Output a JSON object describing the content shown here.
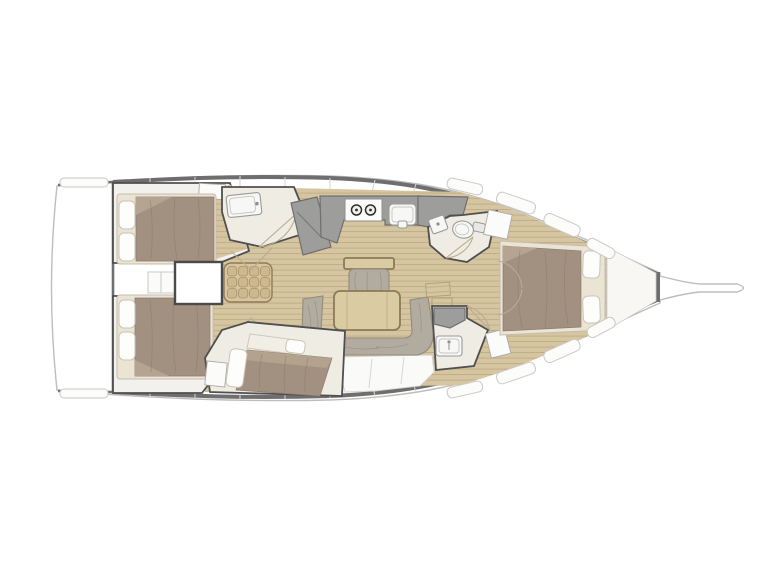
{
  "canvas": {
    "width": 768,
    "height": 576,
    "background": "#ffffff"
  },
  "plan": {
    "kind": "sailing-yacht-interior-floor-plan",
    "orientation": "bow-right-stern-left",
    "colors": {
      "deck_bg": "#ffffff",
      "hull_line": "#bdbdbb",
      "band": "#6e6e6e",
      "panel_line": "#d6d6d4",
      "hatch_line": "#8a8a88",
      "wall": "#4f4f4f",
      "wood": "#d6c5a1",
      "wood_slat": "#c0ab82",
      "step_cell": "#cdb88f",
      "room_floor": "#efece3",
      "bed_base": "#ebe4d5",
      "blanket": "#a29180",
      "blanket_light": "#b5a491",
      "blanket_shadow": "#8c7b6b",
      "pillow": "#fdfdfb",
      "pillow_edge": "#c9c4b4",
      "cushion": "#b2ab9f",
      "cushion_line": "#938b7c",
      "table": "#dbcba2",
      "table_edge": "#8a7a56",
      "counter": "#9d9d9c",
      "counter_edge": "#6f6f6f",
      "fixture": "#f7f7f5",
      "fixture_edge": "#9a9a98",
      "arc": "#b9ab8e"
    },
    "zones": [
      {
        "id": "aft-deck",
        "items": [
          "transom-curve"
        ]
      },
      {
        "id": "aft-cabin-port",
        "items": [
          "double-bed",
          "pillow",
          "pillow",
          "hatched-locker",
          "wood-floor-strip"
        ]
      },
      {
        "id": "aft-cabin-starboard",
        "items": [
          "double-bed",
          "pillow",
          "pillow"
        ]
      },
      {
        "id": "companionway",
        "items": [
          "steps",
          "engine-compartment",
          "shelf-lockers"
        ]
      },
      {
        "id": "head-port",
        "items": [
          "sink",
          "door-swing"
        ]
      },
      {
        "id": "galley",
        "items": [
          "counter",
          "stove-two-burners",
          "sink",
          "fridge-unit"
        ]
      },
      {
        "id": "salon",
        "items": [
          "bench-seat",
          "folding-table",
          "u-shaped-settee",
          "wood-floor"
        ]
      },
      {
        "id": "mid-cabin-starboard",
        "items": [
          "angled-double-bed",
          "pillow",
          "pillow",
          "hatched-locker",
          "headboard"
        ]
      },
      {
        "id": "head-starboard-forward",
        "items": [
          "sink",
          "toilet",
          "door-swing",
          "hanging-locker"
        ]
      },
      {
        "id": "head-starboard-aft",
        "items": [
          "counter",
          "sink",
          "door-swing",
          "hanging-locker"
        ]
      },
      {
        "id": "owner-cabin-bow",
        "items": [
          "island-double-bed",
          "pillow",
          "pillow",
          "wood-floor",
          "door-swing"
        ]
      },
      {
        "id": "foredeck",
        "items": [
          "forepeak-locker",
          "bowsprit"
        ]
      },
      {
        "id": "side-decks",
        "items": [
          "deck-hatches",
          "panel-joints"
        ]
      }
    ]
  }
}
